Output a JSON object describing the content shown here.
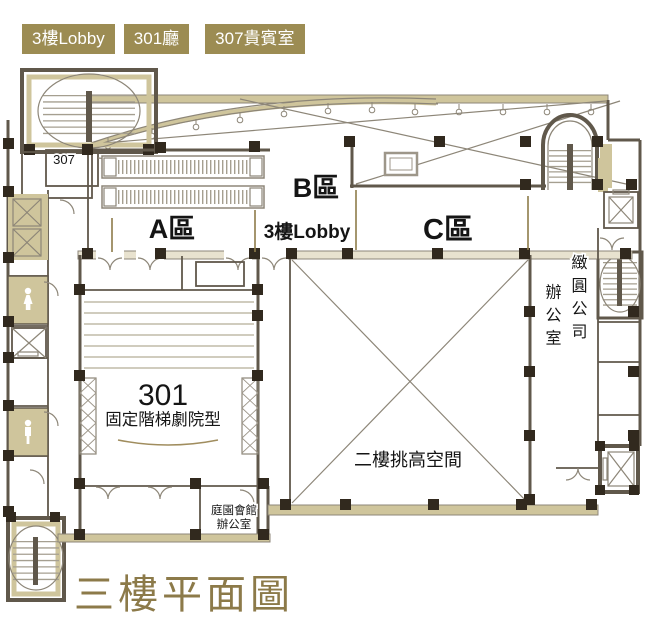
{
  "header": {
    "buttons": [
      {
        "label": "3樓Lobby"
      },
      {
        "label": "301廳"
      },
      {
        "label": "307貴賓室"
      }
    ]
  },
  "plan": {
    "labels": {
      "room_307": "307",
      "zone_a": "A區",
      "zone_b": "B區",
      "lobby_3f": "3樓Lobby",
      "zone_c": "C區",
      "hall_301_number": "301",
      "hall_301_type": "固定階梯劇院型",
      "double_height_space": "二樓挑高空間",
      "office_word": "辦公室",
      "company_name": "緻圓公司",
      "garden_office_line1": "庭園會館",
      "garden_office_line2": "辦公室"
    }
  },
  "footer": {
    "title": "三樓平面圖"
  },
  "colors": {
    "button_olive": "#9c8c53",
    "title_olive": "#8c7a49",
    "wall_dark": "#60584b",
    "band_tan": "#cfc59c"
  }
}
